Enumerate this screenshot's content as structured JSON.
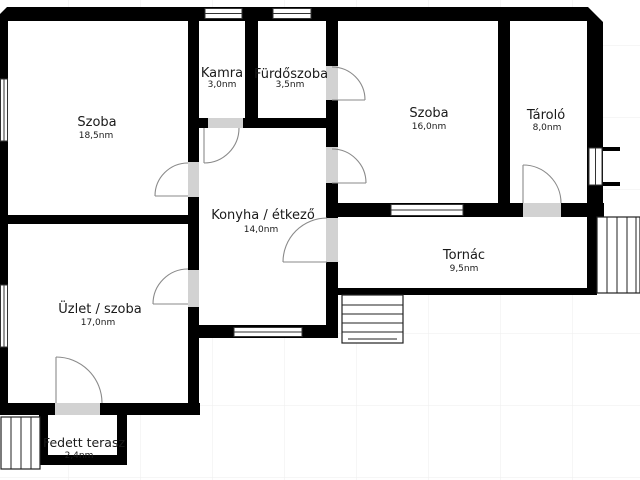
{
  "plan_title": "",
  "rooms": [
    {
      "name": "Szoba",
      "area": "18,5nm"
    },
    {
      "name": "Kamra",
      "area": "3,0nm"
    },
    {
      "name": "Fürdőszoba",
      "area": "3,5nm"
    },
    {
      "name": "Szoba",
      "area": "16,0nm"
    },
    {
      "name": "Tároló",
      "area": "8,0nm"
    },
    {
      "name": "Konyha / étkező",
      "area": "14,0nm"
    },
    {
      "name": "Tornác",
      "area": "9,5nm"
    },
    {
      "name": "Üzlet / szoba",
      "area": "17,0nm"
    },
    {
      "name": "Fedett terasz",
      "area": "2,4nm"
    }
  ],
  "colors": {
    "wall": "#000000",
    "door_opening": "#d2d2d2",
    "background": "#ffffff",
    "room_fill": "#ffffff",
    "grid_line": "#ededed",
    "door_swing": "#8a8a8a",
    "window_frame": "#333333",
    "stair_line": "#222222",
    "text": "#1a1a1a"
  }
}
